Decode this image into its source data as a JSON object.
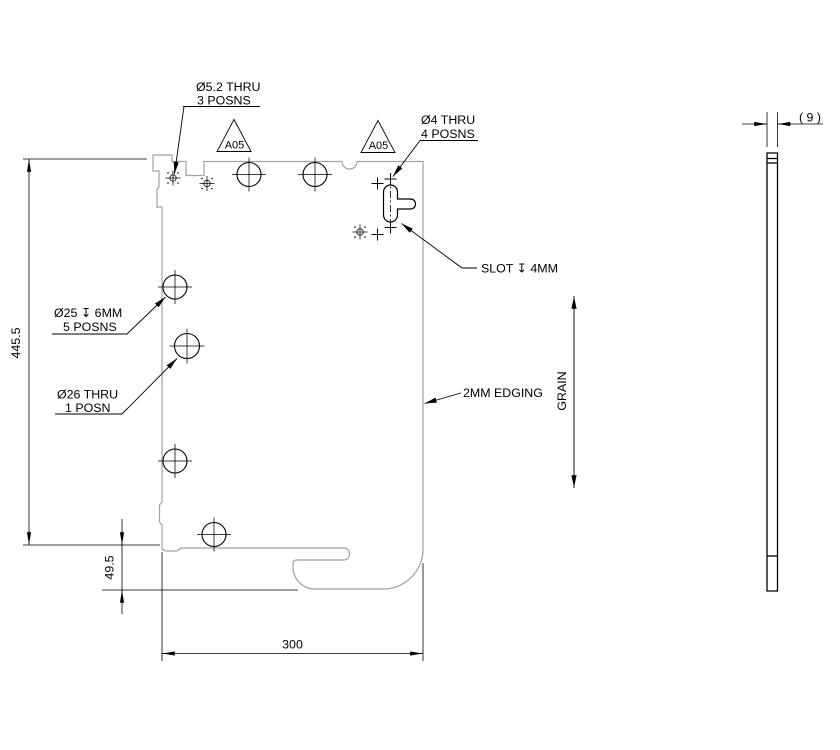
{
  "page": {
    "background": "#ffffff"
  },
  "colors": {
    "line": "#000000",
    "part_outline": "#a2a2a2"
  },
  "front_view": {
    "callouts": {
      "hole_5_2": {
        "line1": "Ø5.2 THRU",
        "line2": "3 POSNS"
      },
      "hole_4": {
        "line1": "Ø4 THRU",
        "line2": "4 POSNS"
      },
      "slot": {
        "label": "SLOT ↧ 4MM"
      },
      "hole_25": {
        "line1": "Ø25 ↧ 6MM",
        "line2": "5 POSNS"
      },
      "hole_26": {
        "line1": "Ø26 THRU",
        "line2": "1 POSN"
      },
      "edging": {
        "label": "2MM EDGING"
      },
      "grain": {
        "label": "GRAIN"
      }
    },
    "flags": {
      "left": "A05",
      "right": "A05"
    },
    "dimensions": {
      "height": "445.5",
      "hook_offset": "49.5",
      "width": "300"
    }
  },
  "side_view": {
    "dimensions": {
      "thickness": "( 9 )"
    }
  }
}
